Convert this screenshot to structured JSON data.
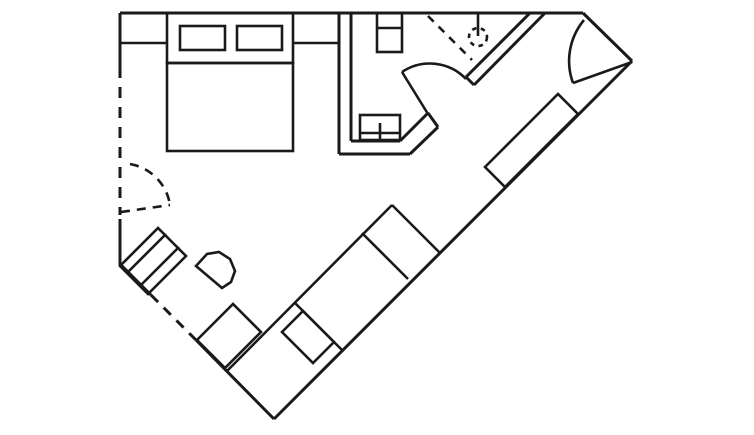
{
  "canvas": {
    "width": 754,
    "height": 435,
    "viewbox": "0 0 754 435",
    "background": "#ffffff",
    "line_color": "#1a1a1a",
    "wall_stroke": 3,
    "furniture_stroke": 2.6,
    "default_dash": "10 8"
  },
  "floor_plan": {
    "description": "single-room floor plan with bathroom, angled walls and furniture",
    "elements": [
      {
        "type": "line",
        "name": "top-wall",
        "kind": "wall",
        "x1": 120,
        "y1": 13,
        "x2": 583,
        "y2": 13
      },
      {
        "type": "line",
        "name": "left-wall-upper",
        "kind": "wall",
        "x1": 120,
        "y1": 13,
        "x2": 120,
        "y2": 67
      },
      {
        "type": "line",
        "name": "left-wall-dashed-opening",
        "kind": "wall",
        "dashed": true,
        "dash": "11 9",
        "x1": 120,
        "y1": 67,
        "x2": 120,
        "y2": 215
      },
      {
        "type": "line",
        "name": "left-wall-lower",
        "kind": "wall",
        "x1": 120,
        "y1": 219,
        "x2": 120,
        "y2": 263
      },
      {
        "type": "line",
        "name": "southwest-wall-upper",
        "kind": "wall",
        "x1": 119,
        "y1": 263,
        "x2": 151,
        "y2": 295
      },
      {
        "type": "line",
        "name": "southwest-wall-dashed-opening",
        "kind": "wall",
        "dashed": true,
        "dash": "10 8",
        "x1": 151,
        "y1": 295,
        "x2": 196,
        "y2": 340
      },
      {
        "type": "line",
        "name": "southwest-wall-lower",
        "kind": "wall",
        "x1": 196,
        "y1": 340,
        "x2": 274,
        "y2": 419
      },
      {
        "type": "line",
        "name": "southeast-wall",
        "kind": "wall",
        "x1": 274,
        "y1": 419,
        "x2": 632,
        "y2": 61
      },
      {
        "type": "line",
        "name": "entry-corner-wall",
        "kind": "wall",
        "x1": 583,
        "y1": 13,
        "x2": 632,
        "y2": 61
      },
      {
        "type": "line",
        "name": "bathroom-outer-wall-vertical",
        "kind": "wall",
        "x1": 339,
        "y1": 13,
        "x2": 339,
        "y2": 154
      },
      {
        "type": "line",
        "name": "bathroom-outer-wall-bottom",
        "kind": "wall",
        "x1": 339,
        "y1": 154,
        "x2": 410,
        "y2": 154
      },
      {
        "type": "line",
        "name": "bathroom-outer-wall-chamfer",
        "kind": "wall",
        "x1": 410,
        "y1": 154,
        "x2": 438,
        "y2": 127
      },
      {
        "type": "line",
        "name": "bathroom-inner-wall-vertical",
        "kind": "wall",
        "x1": 351,
        "y1": 13,
        "x2": 351,
        "y2": 141
      },
      {
        "type": "line",
        "name": "bathroom-inner-wall-bottom",
        "kind": "wall",
        "x1": 351,
        "y1": 141,
        "x2": 400,
        "y2": 141
      },
      {
        "type": "line",
        "name": "bathroom-inner-wall-chamfer",
        "kind": "wall",
        "x1": 400,
        "y1": 141,
        "x2": 428,
        "y2": 113
      },
      {
        "type": "line",
        "name": "bathroom-wall-end-cap",
        "kind": "wall",
        "x1": 428,
        "y1": 113,
        "x2": 438,
        "y2": 127
      },
      {
        "type": "line",
        "name": "corridor-wall-outer",
        "kind": "wall",
        "x1": 530,
        "y1": 13,
        "x2": 466,
        "y2": 77
      },
      {
        "type": "line",
        "name": "corridor-wall-inner",
        "kind": "wall",
        "x1": 545,
        "y1": 13,
        "x2": 474,
        "y2": 85
      },
      {
        "type": "line",
        "name": "corridor-wall-end-cap",
        "kind": "wall",
        "x1": 466,
        "y1": 77,
        "x2": 474,
        "y2": 85
      },
      {
        "type": "line",
        "name": "shower-partition-dashed",
        "kind": "furniture",
        "dashed": true,
        "dash": "8 7",
        "x1": 428,
        "y1": 16,
        "x2": 472,
        "y2": 60
      },
      {
        "type": "line",
        "name": "shower-head-stem",
        "kind": "furniture",
        "x1": 478,
        "y1": 13,
        "x2": 478,
        "y2": 36
      },
      {
        "type": "circle",
        "name": "shower-head-circle-dashed",
        "kind": "furniture",
        "dashed": true,
        "dash": "4.5 4.5",
        "cx": 478,
        "cy": 37,
        "r": 9
      },
      {
        "type": "line",
        "name": "closet-door-leaf-dashed",
        "kind": "furniture",
        "dashed": true,
        "dash": "9 7",
        "x1": 121,
        "y1": 212,
        "x2": 170,
        "y2": 205
      },
      {
        "type": "path",
        "name": "closet-door-swing-arc-dashed",
        "kind": "furniture",
        "dashed": true,
        "dash": "9 7",
        "d": "M 130 164 A 49 49 0 0 1 170 205"
      },
      {
        "type": "rect",
        "name": "bed-headboard",
        "kind": "furniture",
        "x": 167,
        "y": 13,
        "w": 126,
        "h": 50
      },
      {
        "type": "rect",
        "name": "bed",
        "kind": "furniture",
        "x": 167,
        "y": 63,
        "w": 126,
        "h": 88
      },
      {
        "type": "rect",
        "name": "pillow-left",
        "kind": "furniture",
        "x": 180,
        "y": 26,
        "w": 45,
        "h": 24
      },
      {
        "type": "rect",
        "name": "pillow-right",
        "kind": "furniture",
        "x": 237,
        "y": 26,
        "w": 45,
        "h": 24
      },
      {
        "type": "line",
        "name": "nightstand-left-front",
        "kind": "furniture",
        "x1": 120,
        "y1": 43,
        "x2": 167,
        "y2": 43
      },
      {
        "type": "line",
        "name": "nightstand-right-front",
        "kind": "furniture",
        "x1": 293,
        "y1": 43,
        "x2": 339,
        "y2": 43
      },
      {
        "type": "rect",
        "name": "toilet",
        "kind": "furniture",
        "x": 377,
        "y": 13,
        "w": 25,
        "h": 39
      },
      {
        "type": "line",
        "name": "toilet-tank-divider",
        "kind": "furniture",
        "x1": 377,
        "y1": 28,
        "x2": 402,
        "y2": 28
      },
      {
        "type": "rect",
        "name": "sink-vanity",
        "kind": "furniture",
        "x": 360,
        "y": 115,
        "w": 40,
        "h": 25
      },
      {
        "type": "line",
        "name": "sink-front-line",
        "kind": "furniture",
        "x1": 360,
        "y1": 133,
        "x2": 400,
        "y2": 133
      },
      {
        "type": "line",
        "name": "sink-faucet-tick",
        "kind": "furniture",
        "x1": 380,
        "y1": 123,
        "x2": 380,
        "y2": 140
      },
      {
        "type": "line",
        "name": "bathroom-door-leaf",
        "kind": "furniture",
        "x1": 428,
        "y1": 114,
        "x2": 402,
        "y2": 72
      },
      {
        "type": "path",
        "name": "bathroom-door-swing-arc",
        "kind": "furniture",
        "d": "M 402 72 A 50 50 0 0 1 466 79"
      },
      {
        "type": "line",
        "name": "entry-door-leaf",
        "kind": "furniture",
        "x1": 632,
        "y1": 62,
        "x2": 573,
        "y2": 83
      },
      {
        "type": "path",
        "name": "entry-door-swing-arc",
        "kind": "furniture",
        "d": "M 584 20 A 64 64 0 0 0 573 83"
      },
      {
        "type": "polygon",
        "name": "luggage-rack",
        "kind": "furniture",
        "points": "120,266 158,228 186,256 148,294"
      },
      {
        "type": "line",
        "name": "luggage-rack-slat-1",
        "kind": "furniture",
        "x1": 128,
        "y1": 272,
        "x2": 166,
        "y2": 234
      },
      {
        "type": "line",
        "name": "luggage-rack-slat-2",
        "kind": "furniture",
        "x1": 141,
        "y1": 285,
        "x2": 179,
        "y2": 247
      },
      {
        "type": "polygon",
        "name": "chair",
        "kind": "furniture",
        "points": "196,266 207,254 219,252 230,259 235,271 231,282 222,288"
      },
      {
        "type": "polygon",
        "name": "desk",
        "kind": "furniture",
        "points": "197,340 233,304 261,332 225,368"
      },
      {
        "type": "line",
        "name": "sideboard-front-edge",
        "kind": "furniture",
        "x1": 226,
        "y1": 372,
        "x2": 392,
        "y2": 205
      },
      {
        "type": "line",
        "name": "sideboard-end-cap",
        "kind": "furniture",
        "x1": 392,
        "y1": 205,
        "x2": 440,
        "y2": 253
      },
      {
        "type": "line",
        "name": "sideboard-divider-1",
        "kind": "furniture",
        "x1": 295,
        "y1": 303,
        "x2": 342,
        "y2": 350
      },
      {
        "type": "line",
        "name": "sideboard-divider-2",
        "kind": "furniture",
        "x1": 362,
        "y1": 233,
        "x2": 408,
        "y2": 279
      },
      {
        "type": "polygon",
        "name": "ottoman-table",
        "kind": "furniture",
        "points": "282,332 303,311 334,342 313,363"
      },
      {
        "type": "polygon",
        "name": "wardrobe-console",
        "kind": "furniture",
        "points": "485,167 558,94 578,114 505,187"
      }
    ]
  }
}
